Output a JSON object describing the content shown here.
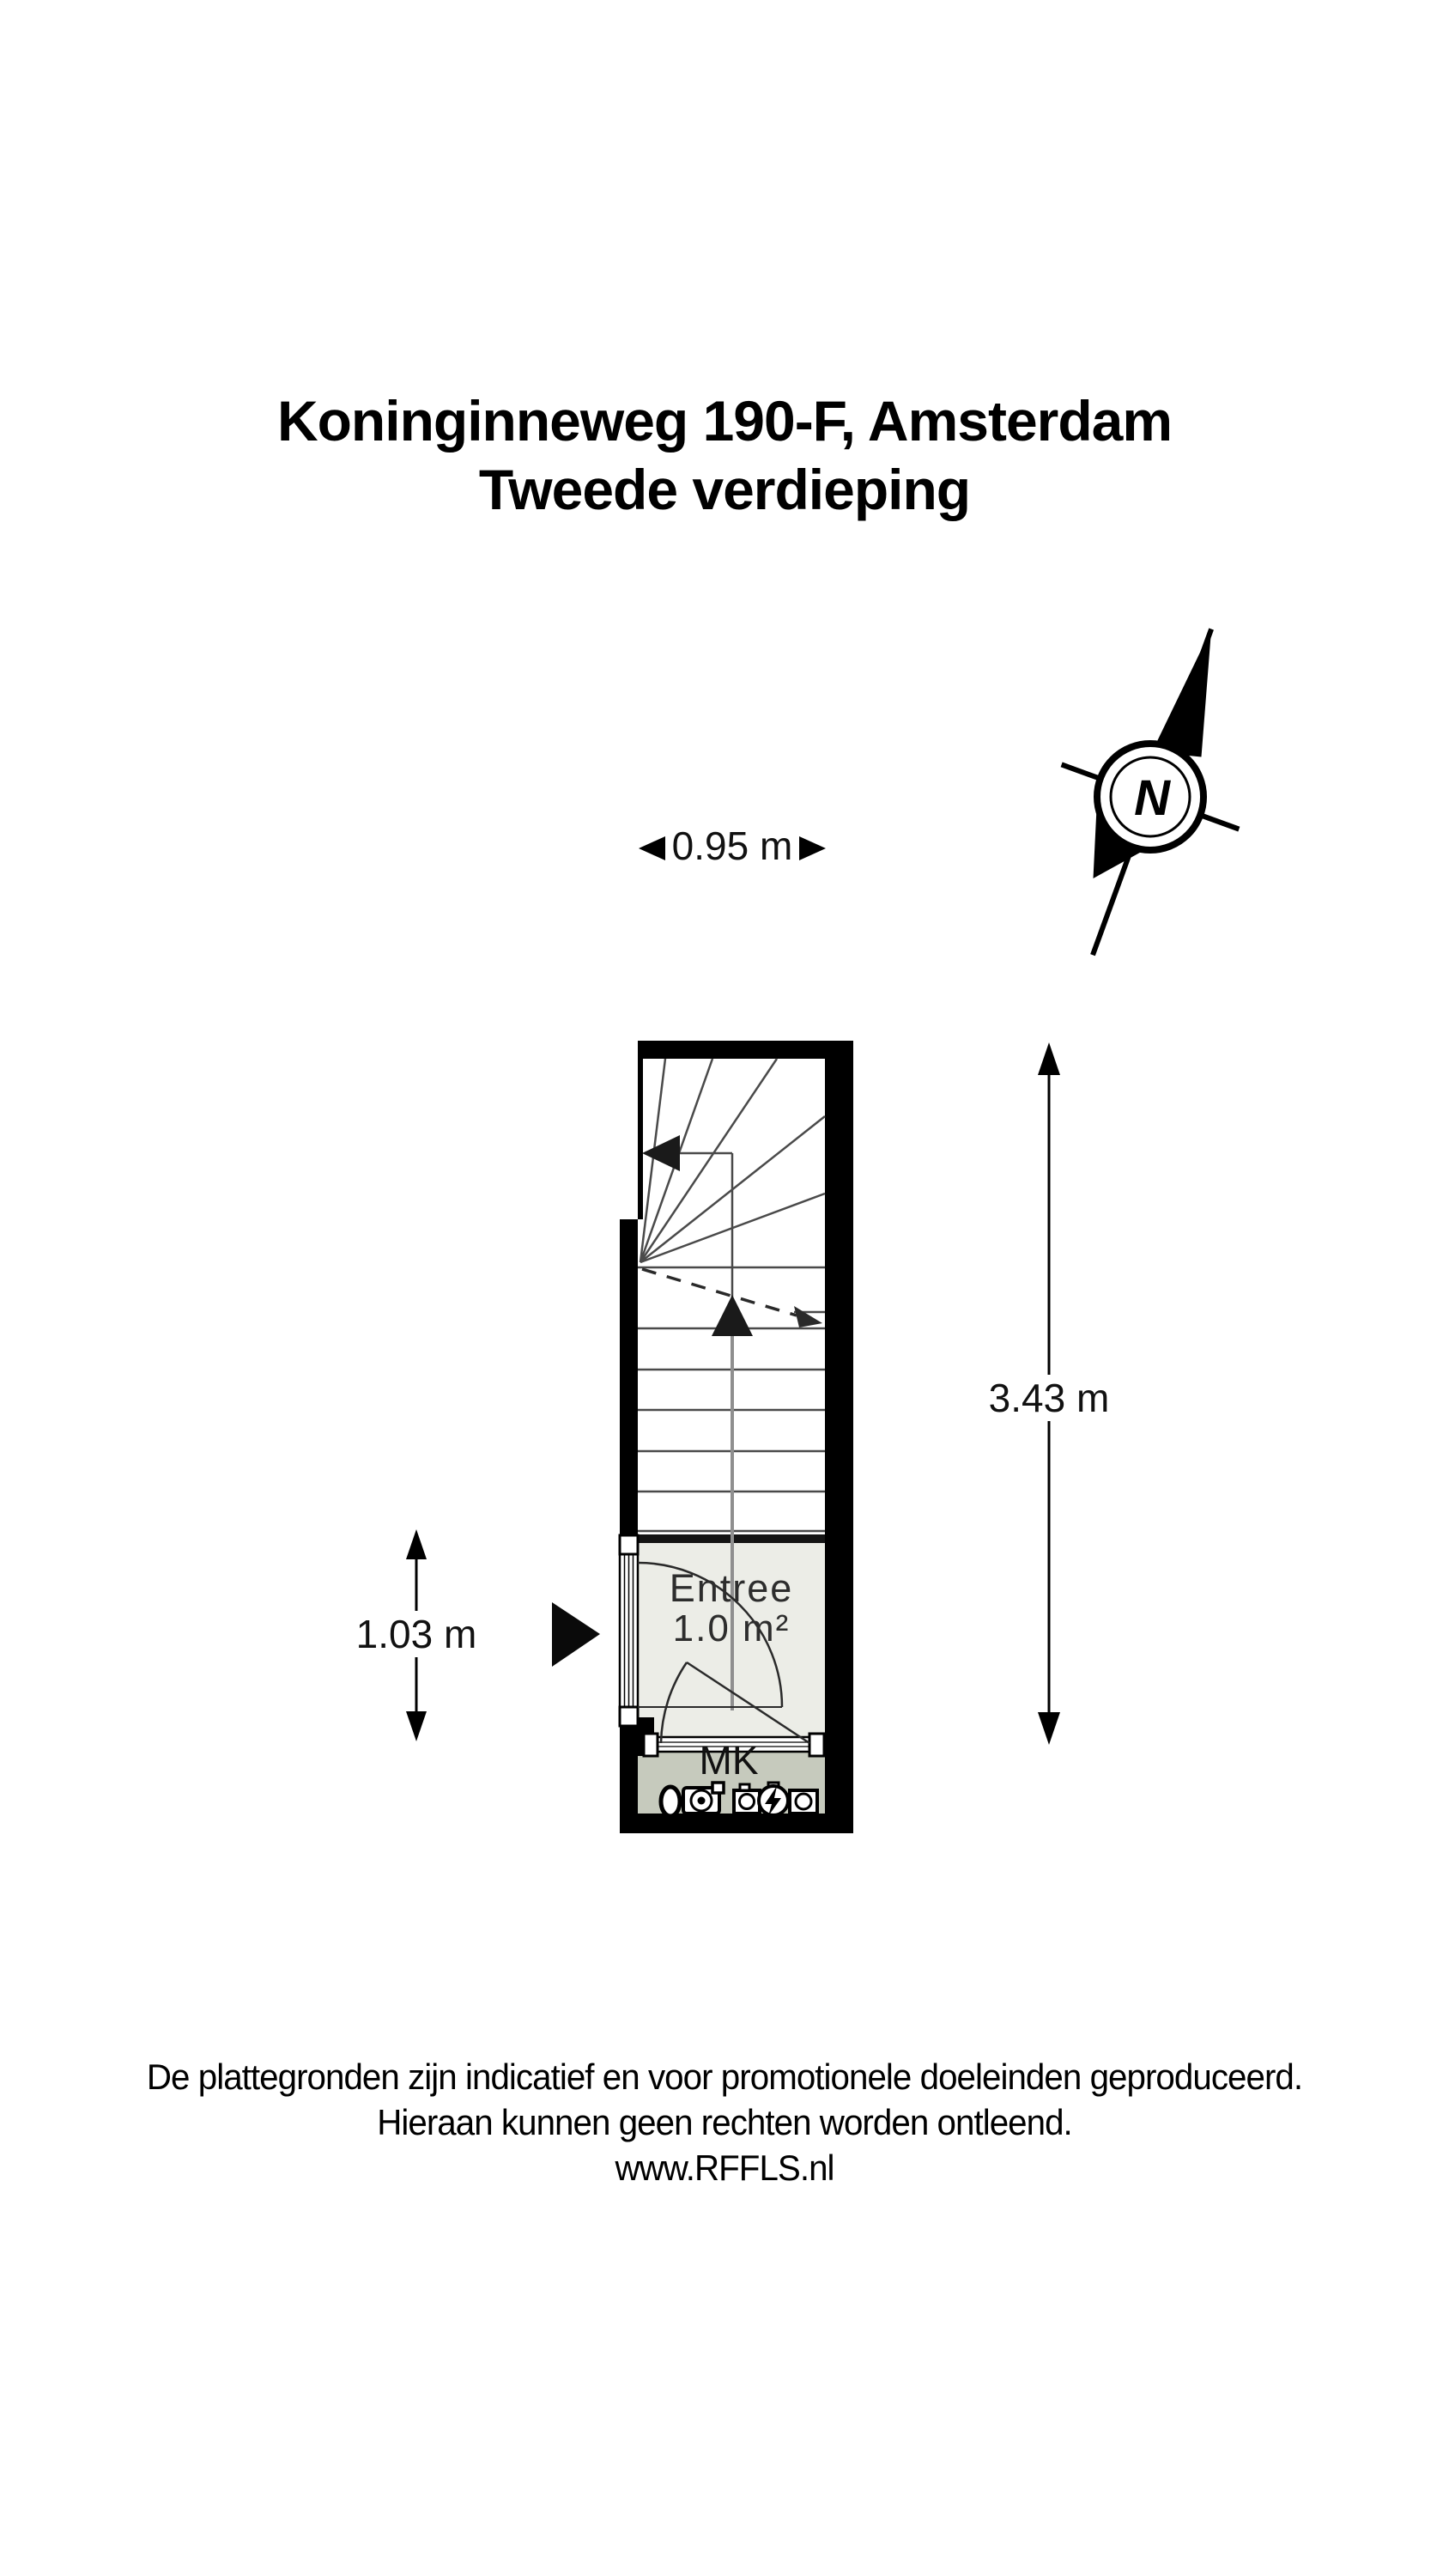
{
  "title": {
    "line1": "Koninginneweg 190-F, Amsterdam",
    "line2": "Tweede verdieping"
  },
  "compass": {
    "label": "N"
  },
  "dimensions": {
    "top_width": "0.95 m",
    "right_height": "3.43 m",
    "left_height": "1.03 m"
  },
  "rooms": {
    "entree": {
      "name": "Entree",
      "area": "1.0 m²"
    },
    "meter_cupboard": {
      "abbreviation": "MK"
    }
  },
  "icons": {
    "north_arrow": "compass-north-arrow",
    "meter_cupboard_symbols": [
      "gas-meter-icon",
      "light-point-icon",
      "meter-box-icon",
      "electricity-meter-icon",
      "water-meter-icon"
    ],
    "stair_direction": "up-arrow-icon",
    "stair_exit": "left-arrow-icon",
    "entrance": "entrance-arrow-icon"
  },
  "footer": {
    "line1": "De plattegronden zijn indicatief en voor promotionele doeleinden geproduceerd.",
    "line2": "Hieraan kunnen geen rechten worden ontleend.",
    "line3": "www.RFFLS.nl"
  },
  "colors": {
    "walls": "#000000",
    "entree_floor": "#ecede7",
    "mk_floor": "#c6cabd",
    "background": "#ffffff",
    "stair_lines": "#4a4a4a"
  }
}
